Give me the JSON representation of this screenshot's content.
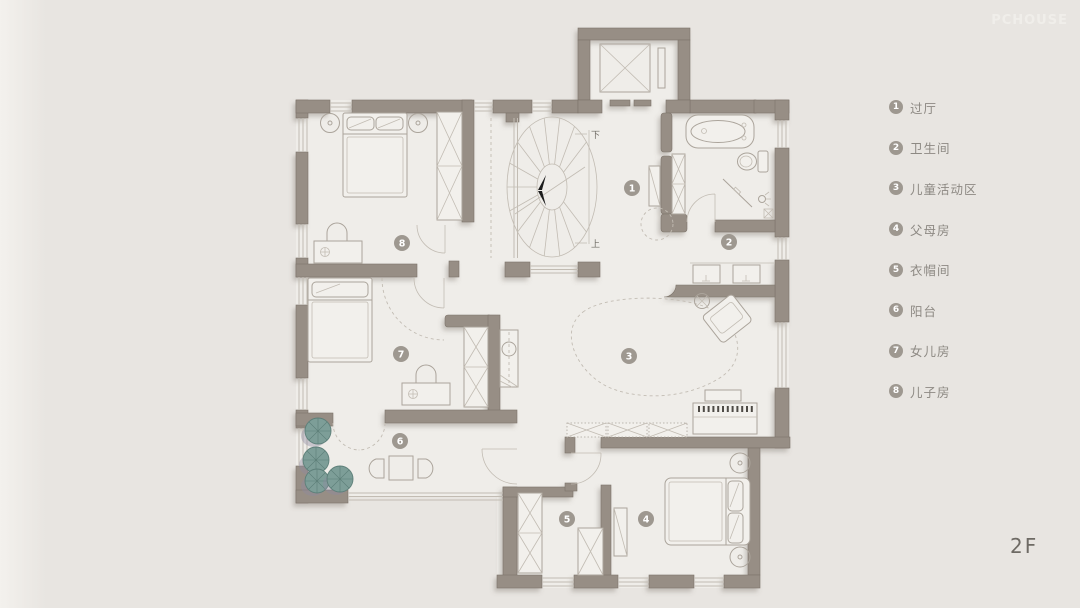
{
  "watermark": "PCHOUSE",
  "floor_label": "2F",
  "legend": {
    "items": [
      {
        "number": "1",
        "label": "过厅"
      },
      {
        "number": "2",
        "label": "卫生间"
      },
      {
        "number": "3",
        "label": "儿童活动区"
      },
      {
        "number": "4",
        "label": "父母房"
      },
      {
        "number": "5",
        "label": "衣帽间"
      },
      {
        "number": "6",
        "label": "阳台"
      },
      {
        "number": "7",
        "label": "女儿房"
      },
      {
        "number": "8",
        "label": "儿子房"
      }
    ]
  },
  "plan": {
    "stairs": {
      "down_label": "下",
      "up_label": "上"
    }
  },
  "colors": {
    "bg": "#e8e5e1",
    "floor": "#efede9",
    "wall": "#978e85",
    "wall-dark": "#7d746b",
    "line": "#aba49b",
    "line-light": "#c2bcb3",
    "badge": "#9e9890",
    "text": "#6e6a64",
    "legend-text": "#8d8983",
    "plant": "#7d9e98",
    "plant-dark": "#5d7f79",
    "watermark": "#f0eeea"
  }
}
